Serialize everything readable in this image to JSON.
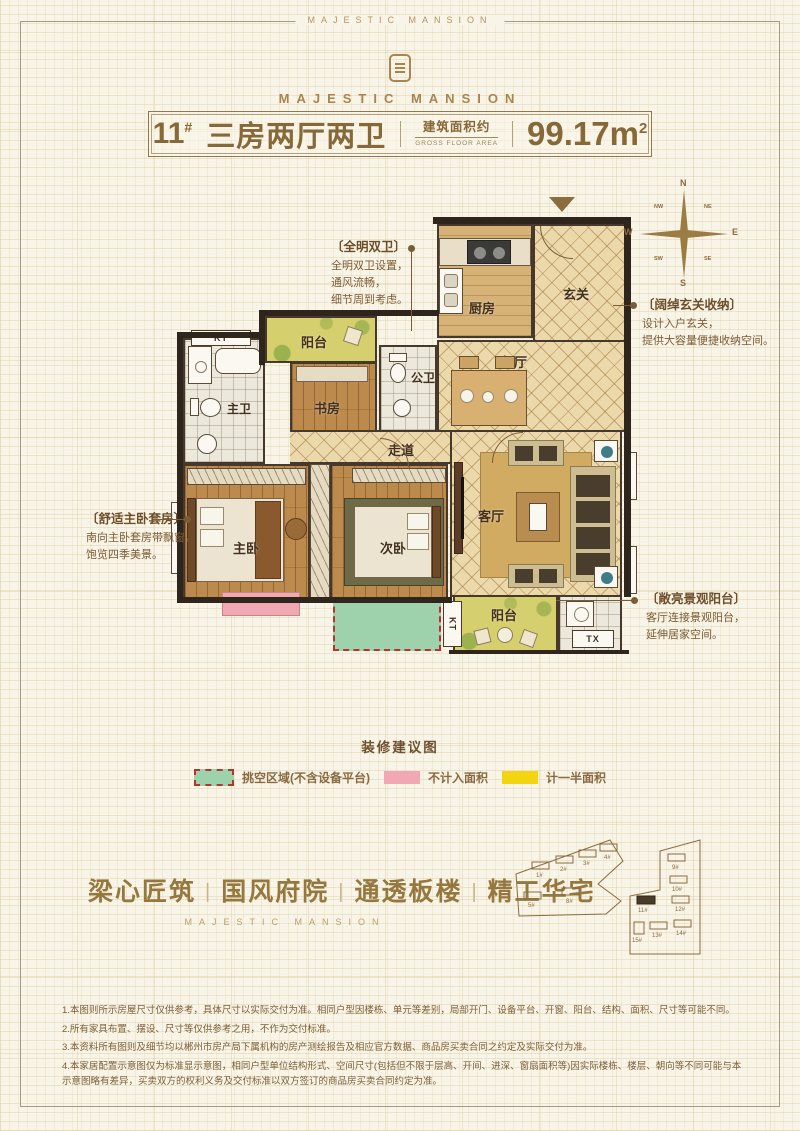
{
  "brand": {
    "frame_text": "MAJESTIC MANSION",
    "logo_text": "MAJESTIC MANSION"
  },
  "title_bar": {
    "unit_number": "11",
    "unit_sup": "#",
    "layout_name": "三房两厅两卫",
    "area_label_cn": "建筑面积约",
    "area_label_en": "GROSS FLOOR AREA",
    "area_value": "99.17",
    "area_unit": "m",
    "area_exp": "2"
  },
  "compass": {
    "n": "N",
    "s": "S",
    "e": "E",
    "w": "W",
    "nw": "NW",
    "ne": "NE",
    "sw": "SW",
    "se": "SE"
  },
  "plan": {
    "rooms": {
      "kitchen": "厨房",
      "foyer": "玄关",
      "dining": "餐厅",
      "public_bath": "公卫",
      "balcony_top": "阳台",
      "study": "书房",
      "master_bath": "主卫",
      "corridor": "走道",
      "master_bedroom": "主卧",
      "second_bedroom": "次卧",
      "living": "客厅",
      "balcony_bottom": "阳台"
    },
    "small_labels": {
      "kt_top": "KT",
      "kt_side": "KT",
      "tx": "TX"
    }
  },
  "annotations": [
    {
      "title": "〔全明双卫〕",
      "lines": [
        "全明双卫设置，",
        "通风流畅，",
        "细节周到考虑。"
      ]
    },
    {
      "title": "〔阔绰玄关收纳〕",
      "lines": [
        "设计入户玄关，",
        "提供大容量便捷收纳空间。"
      ]
    },
    {
      "title": "〔舒适主卧套房〕",
      "lines": [
        "南向主卧套房带飘窗，",
        "饱览四季美景。"
      ]
    },
    {
      "title": "〔敞亮景观阳台〕",
      "lines": [
        "客厅连接景观阳台，",
        "延伸居家空间。"
      ]
    }
  ],
  "legend": {
    "title": "装修建议图",
    "items": [
      {
        "label": "挑空区域(不含设备平台)",
        "color": "#9ed2ac"
      },
      {
        "label": "不计入面积",
        "color": "#f0a9b3"
      },
      {
        "label": "计一半面积",
        "color": "#f2d411"
      }
    ]
  },
  "slogan": {
    "items": [
      "梁心匠筑",
      "国风府院",
      "通透板楼",
      "精工华宅"
    ],
    "divider": "|",
    "sub": "MAJESTIC MANSION"
  },
  "site_plan": {
    "left_buildings": [
      "1#",
      "2#",
      "3#",
      "4#",
      "5#",
      "8#"
    ],
    "right_buildings": [
      "9#",
      "10#",
      "11#",
      "12#",
      "13#",
      "14#",
      "15#"
    ]
  },
  "disclaimer": [
    "1.本图则所示房屋尺寸仅供参考，具体尺寸以实际交付为准。相同户型因楼栋、单元等差别，局部开门、设备平台、开窗、阳台、结构、面积、尺寸等可能不同。",
    "2.所有家具布置、摆设、尺寸等仅供参考之用，不作为交付标准。",
    "3.本资料所有图则及细节均以郴州市房产局下属机构的房产测绘报告及相应官方数据、商品房买卖合同之约定及实际交付为准。",
    "4.本家居配置示意图仅为标准显示意图，相同户型单位结构形式、空间尺寸(包括但不限于层高、开间、进深、窗扇面积等)因实际楼栋、楼层、朝向等不同可能与本示意图略有差异，买卖双方的权利义务及交付标准以双方签订的商品房买卖合同约定为准。"
  ],
  "colors": {
    "accent_gold": "#96783f",
    "wall": "#2e251c",
    "void_green": "#9ed2ac",
    "excluded_pink": "#f0a9b3",
    "half_area_yellow": "#f2d411",
    "void_border_red": "#b5352b"
  }
}
